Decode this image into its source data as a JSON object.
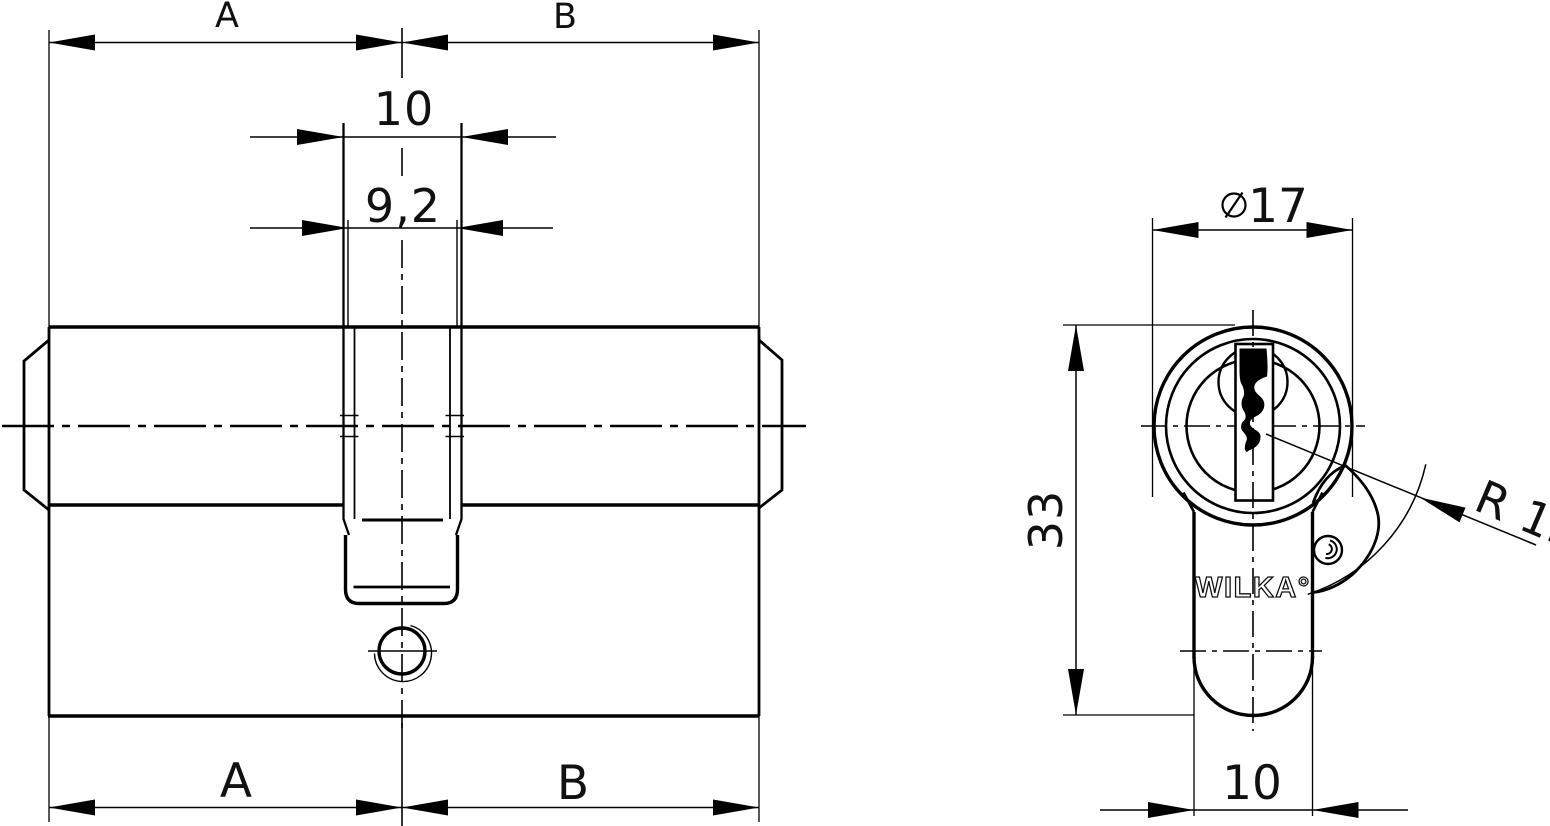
{
  "colors": {
    "background": "#ffffff",
    "line": "#000000",
    "text": "#111111"
  },
  "side_view": {
    "dim_a_top": "A",
    "dim_b_top": "B",
    "dim_cam_width": "10",
    "dim_cam_inner_width": "9,2",
    "dim_a_bottom": "A",
    "dim_b_bottom": "B"
  },
  "front_view": {
    "diameter_symbol": "⌀",
    "diameter_value": "17",
    "height_value": "33",
    "foot_width_value": "10",
    "radius_label": "R 15",
    "brand": "WILKA°"
  }
}
